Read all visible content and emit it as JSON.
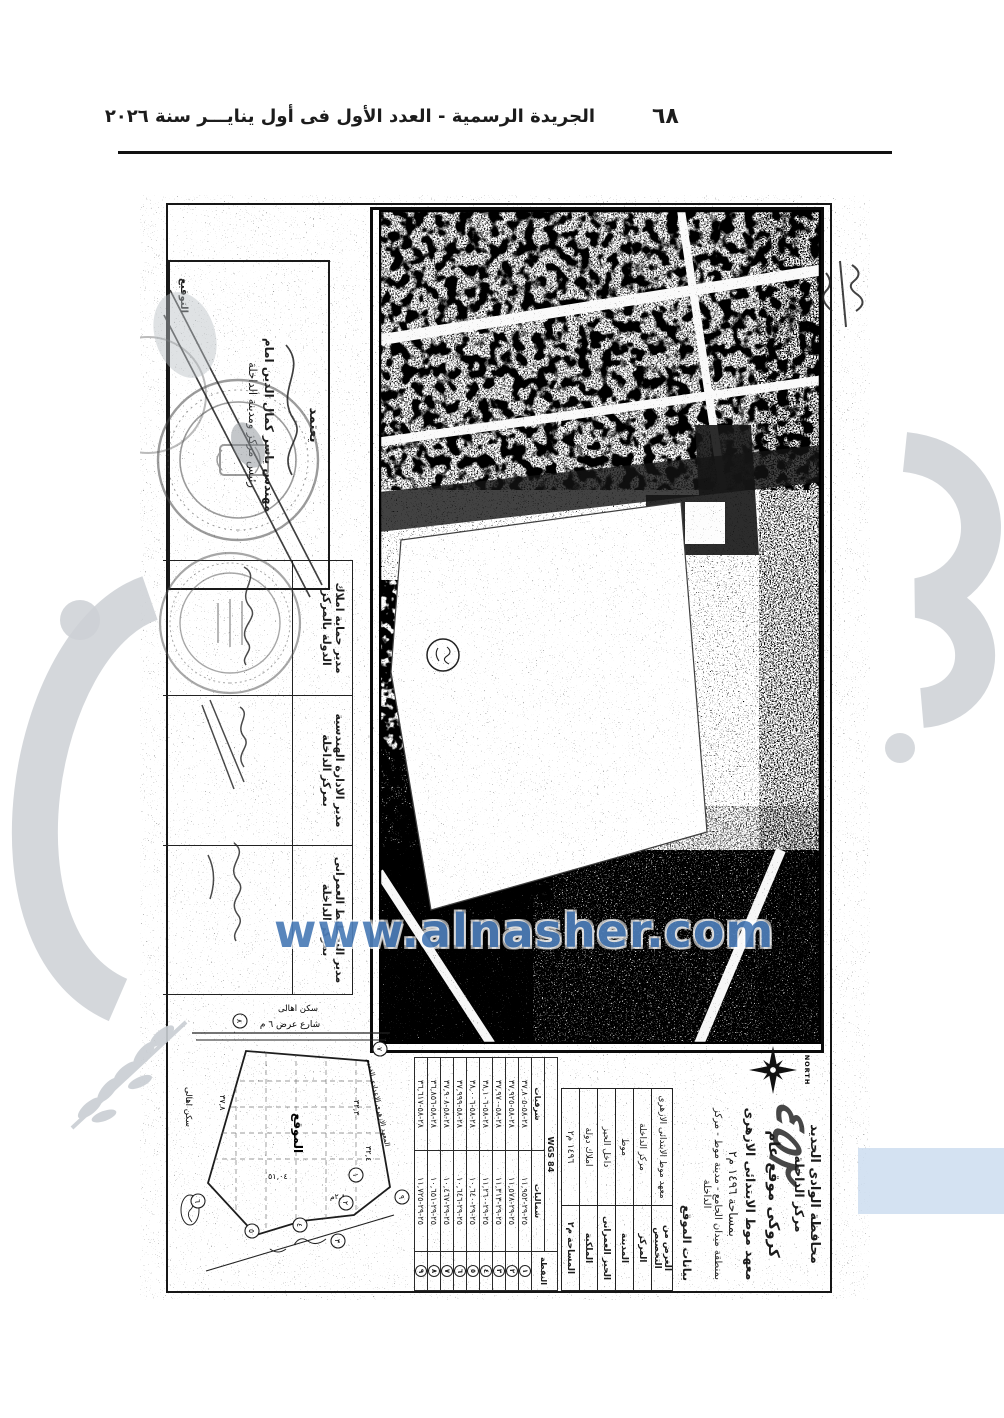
{
  "header": {
    "title": "الجريدة الرسمية - العدد الأول فى أول ينايـــر سنة ٢٠٢٦",
    "page_number": "٦٨"
  },
  "watermarks": {
    "url": "www.alnasher.com",
    "url_color": "#4d7db8",
    "gray_color": "#ccd0d5",
    "pale_blue": "#c5d8ee"
  },
  "doc": {
    "title_block": {
      "gov": "محافظة الوادى الجديد",
      "markaz": "مركز الداخلة",
      "heading": "كروكى موقع عام",
      "subject": "معهد موط الابتدائى الازهرى",
      "area_line": "بمساحة ١٤٩٦ م٢",
      "location_line": "بمنطقة ميدان الجامع - مدينة موط - مركز الداخلة",
      "handwritten_number": "٤٥٢",
      "compass_label": "NORTH"
    },
    "info": {
      "caption": "بيانات الموقع",
      "rows": [
        {
          "label": "الغرض من التخصيص",
          "value": "معهد موط الابتدائى الازهرى"
        },
        {
          "label": "المركز",
          "value": "مركز الداخلة"
        },
        {
          "label": "المدينة",
          "value": "موط"
        },
        {
          "label": "الحيز العمرانى",
          "value": "داخل الحيز"
        },
        {
          "label": "الملكية",
          "value": "املاك دولة"
        },
        {
          "label": "المساحة م٢",
          "value": "١٤٩٦ م٢"
        }
      ]
    },
    "coords": {
      "datum": "WGS 84",
      "point_col": "النقطة",
      "north_col": "شماليات",
      "east_col": "شرقيات",
      "rows": [
        {
          "n": "١",
          "east": "٢٨-٥٨-٣٧,٨٠٥",
          "north": "٢٥-٢٩-١١,٩٥٢"
        },
        {
          "n": "٢",
          "east": "٢٨-٥٨-٣٧,٩٢٥",
          "north": "٢٥-٢٩-١١,٥٧٨"
        },
        {
          "n": "٣",
          "east": "٢٨-٥٨-٣٧,٩٧٠",
          "north": "٢٥-٢٩-١١,٣١٣"
        },
        {
          "n": "٤",
          "east": "٢٨-٥٨-٣٨,١٠٦",
          "north": "٢٥-٢٩-١١,٢٦٠"
        },
        {
          "n": "٥",
          "east": "٢٨-٥٨-٣٨,٠٠٦",
          "north": "٢٥-٢٩-١٠,٦٤٠"
        },
        {
          "n": "٦",
          "east": "٢٨-٥٨-٣٧,٩٩٩",
          "north": "٢٥-٢٩-١٠,٦٤٦"
        },
        {
          "n": "٧",
          "east": "٢٨-٥٨-٣٧,٩٠٨",
          "north": "٢٥-٢٩-١٠,٤٦٧"
        },
        {
          "n": "٨",
          "east": "٢٨-٥٨-٣٦,٨٥٦",
          "north": "٢٥-٢٩-١٠,٦٥١"
        },
        {
          "n": "٩",
          "east": "٢٨-٥٨-٣٦,٦١٧",
          "north": "٢٥-٢٩-١١,٧٢٥"
        }
      ]
    },
    "sketch": {
      "site_label": "الموقع",
      "street_label": "شارع عرض ٦ م",
      "neighbor_top": "سكن اهالى",
      "neighbor_bottom": "سكن اهالى",
      "institute_label": "المعهد الازهرى الاعدادى القديم",
      "dim_a": "٣٢,٣",
      "dim_b": "٣٢,٤",
      "dim_c": "٥١,٠٤",
      "dim_d": "٣٧,٨",
      "dim_e": "٢,٨م",
      "vertices": [
        "١",
        "٢",
        "٣",
        "٤",
        "٥",
        "٦",
        "٧",
        "٨",
        "٩"
      ]
    },
    "signatures": {
      "approval": {
        "stamp_title": "يعتمد",
        "name": "مهندس ياسر كمال الدين امام",
        "role": "رئيس مركز ومدينة الداخلة",
        "sign_label": "التوقيع"
      },
      "officers": [
        {
          "title": "مدير حماية املاك الدولة بالمركز"
        },
        {
          "title": "مدير الادارة الهندسية بمركز الداخلة"
        },
        {
          "title": "مدير التخطيط العمرانى بمركز الداخلة"
        }
      ]
    }
  }
}
